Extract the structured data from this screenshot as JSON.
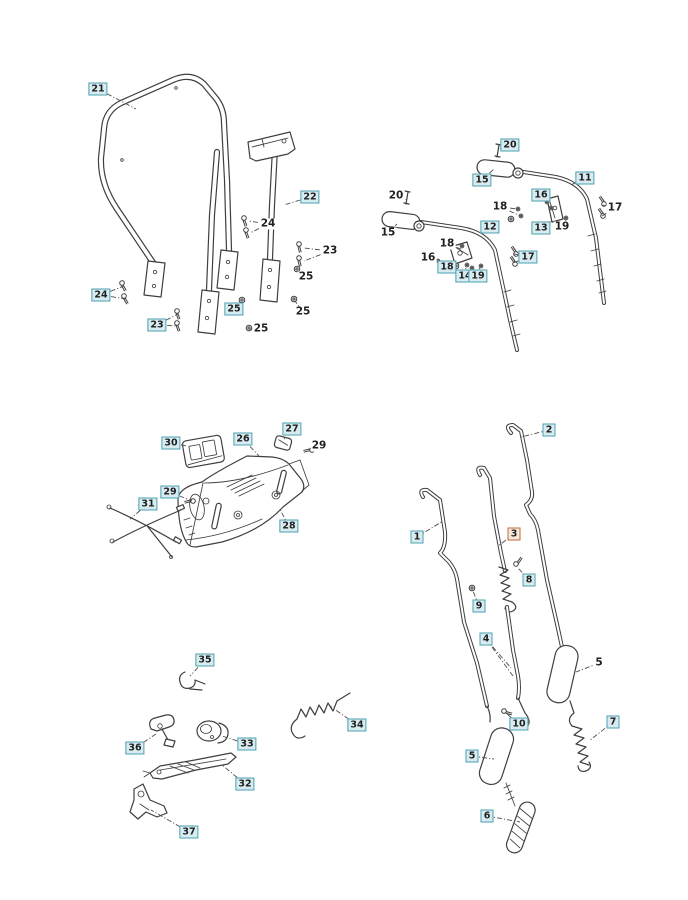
{
  "figure": {
    "type": "exploded-parts-diagram",
    "background": "#ffffff"
  },
  "style": {
    "callout_border": "#4ba2b2",
    "callout_fill": "#d8ebf0",
    "callout_text": "#1f1f1f",
    "highlight_border": "#c06a3a",
    "highlight_fill": "#f7e8dc",
    "line_color": "#3f3f3f",
    "leader_color": "#4d4d4d"
  },
  "callouts": [
    {
      "label": "21",
      "x": 98,
      "y": 89,
      "boxed": true,
      "leaders": [
        [
          136,
          109
        ]
      ]
    },
    {
      "label": "22",
      "x": 310,
      "y": 197,
      "boxed": true,
      "leaders": [
        [
          284,
          205
        ]
      ]
    },
    {
      "label": "24",
      "x": 268,
      "y": 224,
      "boxed": false,
      "leaders": [
        [
          249,
          221
        ],
        [
          250,
          233
        ]
      ]
    },
    {
      "label": "23",
      "x": 330,
      "y": 251,
      "boxed": false,
      "leaders": [
        [
          304,
          248
        ],
        [
          304,
          261
        ]
      ]
    },
    {
      "label": "25",
      "x": 306,
      "y": 277,
      "boxed": false,
      "leaders": [
        [
          298,
          271
        ]
      ]
    },
    {
      "label": "24",
      "x": 101,
      "y": 295,
      "boxed": true,
      "leaders": [
        [
          124,
          286
        ],
        [
          126,
          299
        ]
      ]
    },
    {
      "label": "23",
      "x": 157,
      "y": 325,
      "boxed": true,
      "leaders": [
        [
          178,
          314
        ],
        [
          178,
          326
        ]
      ]
    },
    {
      "label": "25",
      "x": 234,
      "y": 309,
      "boxed": true,
      "leaders": [
        [
          242,
          302
        ]
      ]
    },
    {
      "label": "25",
      "x": 303,
      "y": 312,
      "boxed": false,
      "leaders": [
        [
          295,
          301
        ]
      ]
    },
    {
      "label": "25",
      "x": 261,
      "y": 329,
      "boxed": false,
      "leaders": [
        [
          250,
          329
        ]
      ]
    },
    {
      "label": "20",
      "x": 510,
      "y": 145,
      "boxed": true,
      "leaders": [
        [
          500,
          149
        ]
      ]
    },
    {
      "label": "15",
      "x": 482,
      "y": 180,
      "boxed": true,
      "leaders": [
        [
          494,
          169
        ]
      ]
    },
    {
      "label": "11",
      "x": 585,
      "y": 178,
      "boxed": true,
      "leaders": [
        [
          571,
          185
        ]
      ]
    },
    {
      "label": "20",
      "x": 396,
      "y": 196,
      "boxed": false,
      "leaders": [
        [
          407,
          200
        ]
      ]
    },
    {
      "label": "16",
      "x": 541,
      "y": 195,
      "boxed": true,
      "leaders": [
        [
          549,
          202
        ]
      ]
    },
    {
      "label": "18",
      "x": 500,
      "y": 207,
      "boxed": false,
      "leaders": [
        [
          518,
          209
        ],
        [
          521,
          216
        ]
      ]
    },
    {
      "label": "17",
      "x": 615,
      "y": 208,
      "boxed": false,
      "leaders": [
        [
          603,
          205
        ],
        [
          602,
          216
        ]
      ]
    },
    {
      "label": "13",
      "x": 541,
      "y": 228,
      "boxed": true,
      "leaders": [
        [
          552,
          221
        ]
      ]
    },
    {
      "label": "19",
      "x": 562,
      "y": 227,
      "boxed": false,
      "leaders": [
        [
          566,
          219
        ]
      ]
    },
    {
      "label": "15",
      "x": 388,
      "y": 233,
      "boxed": false,
      "leaders": [
        [
          397,
          224
        ]
      ]
    },
    {
      "label": "12",
      "x": 490,
      "y": 227,
      "boxed": true,
      "leaders": [
        [
          481,
          231
        ]
      ]
    },
    {
      "label": "18",
      "x": 447,
      "y": 244,
      "boxed": false,
      "leaders": [
        [
          461,
          249
        ]
      ]
    },
    {
      "label": "16",
      "x": 428,
      "y": 258,
      "boxed": false,
      "leaders": [
        [
          438,
          261
        ]
      ]
    },
    {
      "label": "18",
      "x": 447,
      "y": 267,
      "boxed": true,
      "leaders": [
        [
          457,
          266
        ]
      ]
    },
    {
      "label": "17",
      "x": 528,
      "y": 257,
      "boxed": true,
      "leaders": [
        [
          514,
          254
        ],
        [
          513,
          263
        ]
      ]
    },
    {
      "label": "14",
      "x": 465,
      "y": 276,
      "boxed": true,
      "leaders": [
        [
          466,
          267
        ]
      ]
    },
    {
      "label": "19",
      "x": 478,
      "y": 276,
      "boxed": true,
      "leaders": [
        [
          480,
          267
        ]
      ]
    },
    {
      "label": "30",
      "x": 171,
      "y": 443,
      "boxed": true,
      "leaders": [
        [
          187,
          446
        ]
      ]
    },
    {
      "label": "26",
      "x": 243,
      "y": 439,
      "boxed": true,
      "leaders": [
        [
          259,
          456
        ]
      ]
    },
    {
      "label": "27",
      "x": 292,
      "y": 429,
      "boxed": true,
      "leaders": [
        [
          284,
          439
        ]
      ]
    },
    {
      "label": "29",
      "x": 319,
      "y": 446,
      "boxed": false,
      "leaders": [
        [
          312,
          451
        ]
      ]
    },
    {
      "label": "29",
      "x": 170,
      "y": 492,
      "boxed": true,
      "leaders": [
        [
          192,
          501
        ]
      ]
    },
    {
      "label": "31",
      "x": 148,
      "y": 504,
      "boxed": true,
      "leaders": [
        [
          130,
          519
        ]
      ]
    },
    {
      "label": "28",
      "x": 289,
      "y": 526,
      "boxed": true,
      "leaders": [
        [
          279,
          508
        ]
      ]
    },
    {
      "label": "2",
      "x": 549,
      "y": 430,
      "boxed": true,
      "leaders": [
        [
          521,
          437
        ]
      ]
    },
    {
      "label": "1",
      "x": 417,
      "y": 537,
      "boxed": true,
      "leaders": [
        [
          443,
          521
        ]
      ]
    },
    {
      "label": "3",
      "x": 514,
      "y": 534,
      "boxed": true,
      "highlighted": true,
      "leaders": [
        [
          498,
          546
        ]
      ]
    },
    {
      "label": "8",
      "x": 529,
      "y": 580,
      "boxed": true,
      "leaders": [
        [
          518,
          568
        ]
      ]
    },
    {
      "label": "9",
      "x": 479,
      "y": 606,
      "boxed": true,
      "leaders": [
        [
          473,
          591
        ]
      ]
    },
    {
      "label": "4",
      "x": 486,
      "y": 639,
      "boxed": true,
      "leaders": [
        [
          511,
          668
        ],
        [
          513,
          676
        ]
      ]
    },
    {
      "label": "5",
      "x": 599,
      "y": 663,
      "boxed": false,
      "leaders": [
        [
          576,
          672
        ]
      ]
    },
    {
      "label": "10",
      "x": 519,
      "y": 724,
      "boxed": true,
      "leaders": [
        [
          507,
          714
        ]
      ]
    },
    {
      "label": "7",
      "x": 613,
      "y": 722,
      "boxed": true,
      "leaders": [
        [
          589,
          741
        ]
      ]
    },
    {
      "label": "5",
      "x": 472,
      "y": 756,
      "boxed": true,
      "leaders": [
        [
          494,
          759
        ]
      ]
    },
    {
      "label": "6",
      "x": 487,
      "y": 816,
      "boxed": true,
      "leaders": [
        [
          520,
          822
        ]
      ]
    },
    {
      "label": "35",
      "x": 205,
      "y": 660,
      "boxed": true,
      "leaders": [
        [
          190,
          676
        ]
      ]
    },
    {
      "label": "34",
      "x": 357,
      "y": 725,
      "boxed": true,
      "leaders": [
        [
          330,
          706
        ]
      ]
    },
    {
      "label": "33",
      "x": 247,
      "y": 744,
      "boxed": true,
      "leaders": [
        [
          222,
          736
        ]
      ]
    },
    {
      "label": "36",
      "x": 135,
      "y": 748,
      "boxed": true,
      "leaders": [
        [
          156,
          734
        ]
      ]
    },
    {
      "label": "32",
      "x": 245,
      "y": 784,
      "boxed": true,
      "leaders": [
        [
          222,
          765
        ]
      ]
    },
    {
      "label": "37",
      "x": 189,
      "y": 832,
      "boxed": true,
      "leaders": [
        [
          151,
          810
        ]
      ]
    }
  ]
}
